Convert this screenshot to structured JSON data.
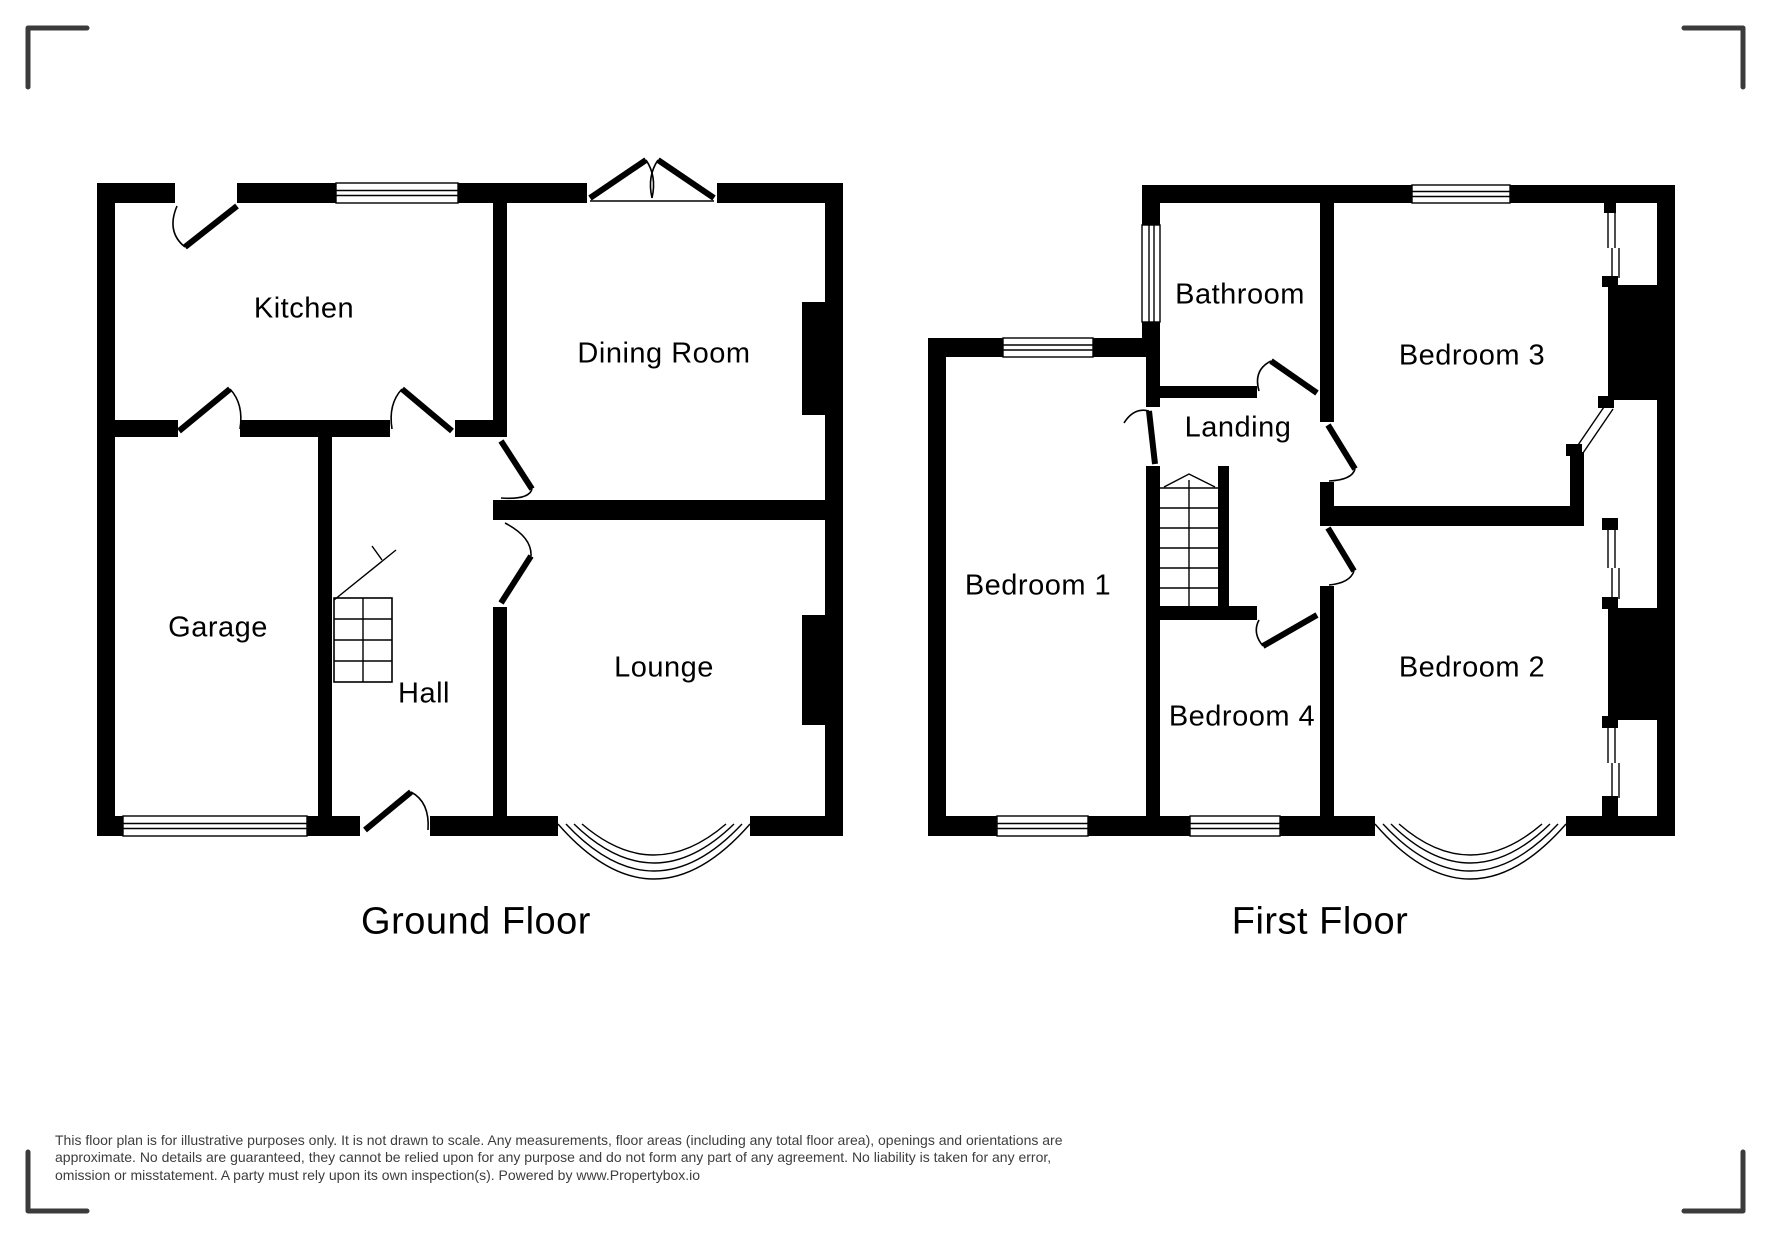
{
  "page": {
    "background": "#ffffff"
  },
  "drawing": {
    "wall_color": "#000000",
    "corner_mark_color": "#3b3b3b",
    "label_color": "#000000",
    "disclaimer_color": "#3d3d3d"
  },
  "ground_floor": {
    "title": "Ground Floor",
    "rooms": {
      "kitchen": "Kitchen",
      "dining": "Dining Room",
      "garage": "Garage",
      "hall": "Hall",
      "lounge": "Lounge"
    }
  },
  "first_floor": {
    "title": "First Floor",
    "rooms": {
      "bathroom": "Bathroom",
      "bedroom3": "Bedroom 3",
      "landing": "Landing",
      "bedroom1": "Bedroom 1",
      "bedroom4": "Bedroom 4",
      "bedroom2": "Bedroom 2"
    }
  },
  "disclaimer": {
    "line1": "This floor plan is for illustrative purposes only. It is not drawn to scale. Any measurements, floor areas (including any total floor area), openings and orientations are",
    "line2": "approximate. No details are guaranteed, they cannot be relied upon for any purpose and do not form any part of any agreement. No liability is taken for any error,",
    "line3": "omission or misstatement. A party must rely upon its own inspection(s). Powered by www.Propertybox.io"
  }
}
